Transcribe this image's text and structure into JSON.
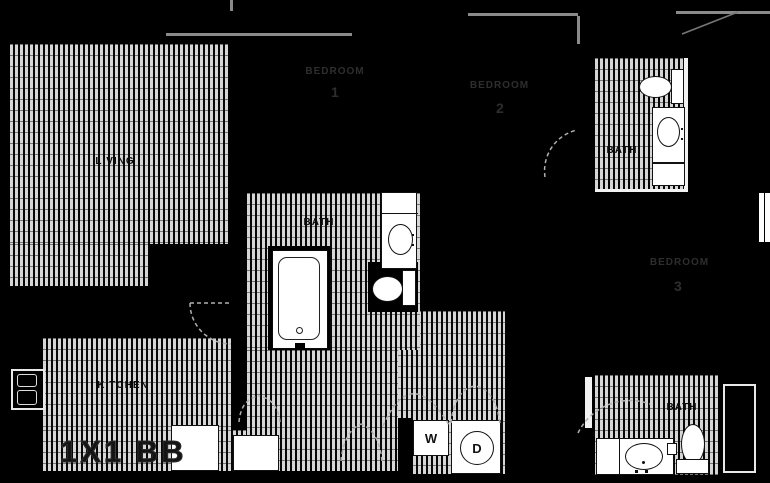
{
  "plan": {
    "name": "1X1 BB"
  },
  "rooms": {
    "living": {
      "label": "LIVING"
    },
    "kitchen": {
      "label": "KITCHEN"
    },
    "bath_main": {
      "label": "BATH"
    },
    "bath_2": {
      "label": "BATH"
    },
    "bath_3": {
      "label": "BATH"
    },
    "bedroom_1": {
      "label": "BEDROOM",
      "number": "1"
    },
    "bedroom_2": {
      "label": "BEDROOM",
      "number": "2"
    },
    "bedroom_3": {
      "label": "BEDROOM",
      "number": "3"
    }
  },
  "appliances": {
    "washer": "W",
    "dryer": "D"
  },
  "icons": {
    "bathtub-icon": "rounded rectangle tub with drain dot",
    "toilet-icon": "oval bowl with rectangular tank",
    "sink-icon": "oval basin in white vanity counter",
    "fridge-icon": "outlined two-door box",
    "range-icon": "white square appliance",
    "dishwasher-icon": "white square appliance",
    "door-swing-icon": "dashed quarter-circle arc",
    "bifold-door-icon": "dashed double peak arc"
  },
  "colors": {
    "background": "#000000",
    "floor_hatch_light": "#d6d6d6",
    "floor_hatch_dark": "#070707",
    "fixture_white": "#ffffff",
    "wall_gray": "#8a8a8a",
    "room_label": "#0b0b0b",
    "dim_label": "#2e2e2e"
  }
}
